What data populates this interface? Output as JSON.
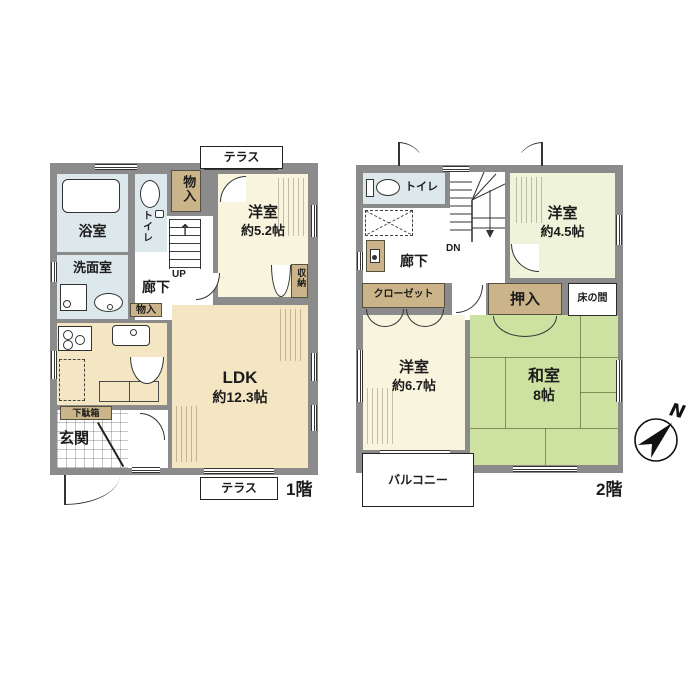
{
  "palette": {
    "wall": "#8b8b8b",
    "ldk_cream": "#f5e6c3",
    "western_cream": "#f8f4de",
    "western_pale_green": "#eef3d9",
    "tatami_green": "#cde1a0",
    "water_blue": "#dde8ec",
    "storage_tan": "#cbb489",
    "line": "#2a2a2a"
  },
  "floor1": {
    "floor_label": "1階",
    "terrace_top": "テラス",
    "terrace_bottom": "テラス",
    "bathroom": "浴室",
    "toilet": "トイレ",
    "storage_top": "物入",
    "western_room": {
      "name": "洋室",
      "size": "約5.2帖"
    },
    "closet": "収納",
    "washroom": "洗面室",
    "hallway": "廊下",
    "stairs_label": "UP",
    "stairs_arrow": "↑",
    "storage_small": "物入",
    "ldk": {
      "name": "LDK",
      "size": "約12.3帖"
    },
    "shoe_cabinet": "下駄箱",
    "entrance": "玄関"
  },
  "floor2": {
    "floor_label": "2階",
    "toilet": "トイレ",
    "stairs_label": "DN",
    "stairs_arrow": "↓",
    "hallway": "廊下",
    "western_room_small": {
      "name": "洋室",
      "size": "約4.5帖"
    },
    "closet": "クローゼット",
    "oshiire": "押入",
    "tokonoma": "床の間",
    "western_room_large": {
      "name": "洋室",
      "size": "約6.7帖"
    },
    "japanese_room": {
      "name": "和室",
      "size": "8帖"
    },
    "balcony": "バルコニー",
    "compass_north": "N"
  }
}
